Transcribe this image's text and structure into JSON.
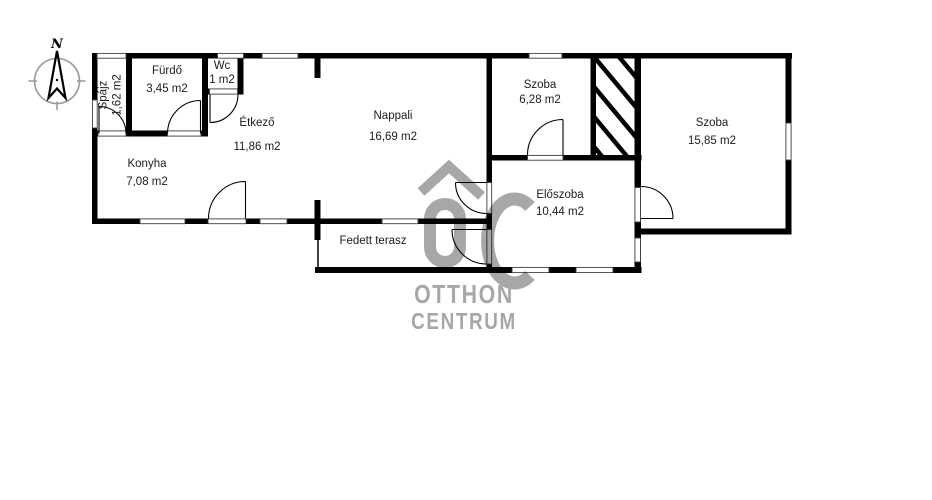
{
  "compass": {
    "label": "N"
  },
  "rooms": [
    {
      "name": "Spájz",
      "area": "1,62 m2"
    },
    {
      "name": "Fürdő",
      "area": "3,45 m2"
    },
    {
      "name": "Wc",
      "area": "1 m2"
    },
    {
      "name": "Étkező",
      "area": "11,86 m2"
    },
    {
      "name": "Nappali",
      "area": "16,69 m2"
    },
    {
      "name": "Konyha",
      "area": "7,08 m2"
    },
    {
      "name": "Szoba",
      "area": "6,28 m2"
    },
    {
      "name": "Előszoba",
      "area": "10,44 m2"
    },
    {
      "name": "Szoba",
      "area": "15,85 m2"
    },
    {
      "name": "Fedett terasz",
      "area": ""
    }
  ],
  "watermark": {
    "brand_line1": "OTTHON",
    "brand_line2": "CENTRUM"
  },
  "colors": {
    "wall": "#000000",
    "opening_line": "#3c3c3c",
    "compass_gray": "#9b9b9b",
    "watermark_gray": "#a7a7a7"
  }
}
